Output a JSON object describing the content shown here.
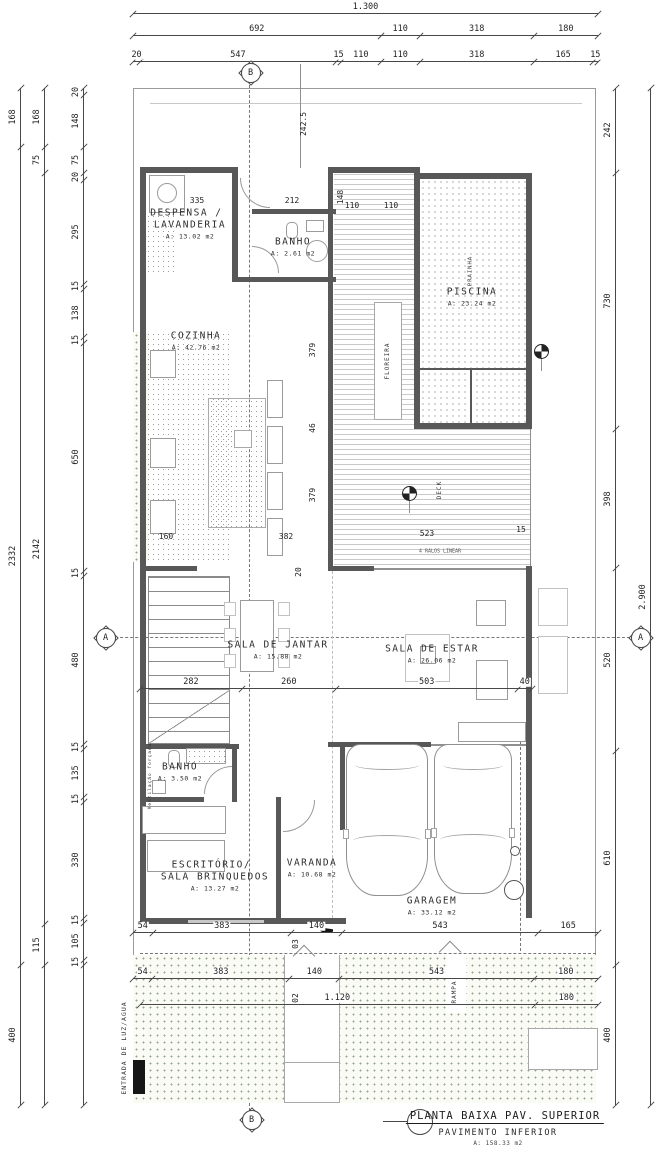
{
  "drawing": {
    "colors": {
      "wall": "#585858",
      "dim_line": "#474747",
      "yard_dot": "#93a393",
      "deck_stripe": "#c9c9c9"
    },
    "title_block": {
      "title": "PLANTA BAIXA PAV. SUPERIOR",
      "subtitle": "PAVIMENTO INFERIOR",
      "area": "A: 158.33 m2"
    },
    "rooms": [
      {
        "id": "despensa",
        "name": "DESPENSA /",
        "name2": "LAVANDERIA",
        "area": "A: 13.02 m2",
        "x": 190,
        "y": 224
      },
      {
        "id": "banho1",
        "name": "BANHO",
        "name2": "",
        "area": "A: 2.61 m2",
        "x": 293,
        "y": 247
      },
      {
        "id": "cozinha",
        "name": "COZINHA",
        "name2": "",
        "area": "A: 42.76 m2",
        "x": 196,
        "y": 341
      },
      {
        "id": "piscina",
        "name": "PISCINA",
        "name2": "",
        "area": "A: 23.24 m2",
        "x": 472,
        "y": 297
      },
      {
        "id": "jantar",
        "name": "SALA DE JANTAR",
        "name2": "",
        "area": "A: 15.88 m2",
        "x": 278,
        "y": 650
      },
      {
        "id": "estar",
        "name": "SALA DE ESTAR",
        "name2": "",
        "area": "A: 26.06 m2",
        "x": 432,
        "y": 654
      },
      {
        "id": "banho2",
        "name": "BANHO",
        "name2": "",
        "area": "A: 3.50 m2",
        "x": 180,
        "y": 772
      },
      {
        "id": "escritorio",
        "name": "ESCRITÓRIO/",
        "name2": "SALA BRINQUEDOS",
        "area": "A: 13.27 m2",
        "x": 215,
        "y": 876
      },
      {
        "id": "varanda",
        "name": "VARANDA",
        "name2": "",
        "area": "A: 10.68 m2",
        "x": 312,
        "y": 868
      },
      {
        "id": "garagem",
        "name": "GARAGEM",
        "name2": "",
        "area": "A: 33.12 m2",
        "x": 432,
        "y": 906
      }
    ],
    "vertical_labels": [
      {
        "text": "FLOREIRA",
        "x": 388,
        "y": 361,
        "size": 6
      },
      {
        "text": "PRAINHA",
        "x": 471,
        "y": 271,
        "size": 5.5
      },
      {
        "text": "DECK",
        "x": 440,
        "y": 490,
        "size": 6
      },
      {
        "text": "RAMPA",
        "x": 455,
        "y": 992,
        "size": 6
      },
      {
        "text": "ENTRADA DE LUZ/AGUA",
        "x": 124,
        "y": 1048,
        "size": 6.5
      },
      {
        "text": "Ventilação forçada",
        "x": 151,
        "y": 776,
        "size": 4.5
      }
    ],
    "markers": [
      {
        "letter": "B",
        "x": 250,
        "y": 72
      },
      {
        "letter": "B",
        "x": 251,
        "y": 1119
      },
      {
        "letter": "A",
        "x": 105,
        "y": 637
      },
      {
        "letter": "A",
        "x": 640,
        "y": 637
      }
    ],
    "dim_rows": [
      {
        "id": "top-total",
        "y": 13,
        "x1": 133,
        "x2": 598,
        "values": [
          "1.300"
        ],
        "weights": [
          1
        ]
      },
      {
        "id": "top-2",
        "y": 35,
        "x1": 133,
        "x2": 598,
        "values": [
          "692",
          "110",
          "318",
          "180"
        ],
        "weights": [
          692,
          110,
          318,
          180
        ]
      },
      {
        "id": "top-3",
        "y": 61,
        "x1": 133,
        "x2": 598,
        "values": [
          "20",
          "547",
          "15",
          "110",
          "110",
          "318",
          "165",
          "15"
        ],
        "weights": [
          20,
          547,
          15,
          110,
          110,
          318,
          165,
          15
        ]
      },
      {
        "id": "mid",
        "y": 688,
        "x1": 140,
        "x2": 532,
        "values": [
          "282",
          "260",
          "503",
          "40"
        ],
        "weights": [
          282,
          260,
          503,
          40
        ]
      },
      {
        "id": "bottom-1",
        "y": 932,
        "x1": 133,
        "x2": 598,
        "values": [
          "54",
          "383",
          "140",
          "543",
          "165"
        ],
        "weights": [
          54,
          383,
          140,
          543,
          165
        ]
      },
      {
        "id": "bottom-2",
        "y": 978,
        "x1": 133,
        "x2": 598,
        "values": [
          "54",
          "383",
          "140",
          "543",
          "180"
        ],
        "weights": [
          54,
          383,
          140,
          543,
          180
        ]
      },
      {
        "id": "bottom-3",
        "y": 1004,
        "x1": 140,
        "x2": 598,
        "values": [
          "1.120",
          "180"
        ],
        "weights": [
          1120,
          180
        ]
      }
    ],
    "dim_cols": [
      {
        "id": "left-outer",
        "x": 20,
        "y1": 88,
        "y2": 1105,
        "values": [
          "168",
          "2332",
          "400"
        ],
        "weights": [
          168,
          2332,
          400
        ]
      },
      {
        "id": "left-mid",
        "x": 44,
        "y1": 88,
        "y2": 1105,
        "values": [
          "168",
          "75",
          "2142",
          "115",
          ""
        ],
        "weights": [
          168,
          75,
          2142,
          115,
          400
        ]
      },
      {
        "id": "left-inner",
        "x": 83,
        "y1": 88,
        "y2": 1105,
        "values": [
          "20",
          "148",
          "75",
          "20",
          "295",
          "15",
          "138",
          "15",
          "650",
          "15",
          "480",
          "15",
          "135",
          "15",
          "330",
          "15",
          "105",
          "15",
          ""
        ],
        "weights": [
          20,
          148,
          75,
          20,
          295,
          15,
          138,
          15,
          650,
          15,
          480,
          15,
          135,
          15,
          330,
          15,
          105,
          15,
          399
        ]
      },
      {
        "id": "right-inner",
        "x": 615,
        "y1": 88,
        "y2": 1105,
        "values": [
          "242",
          "730",
          "398",
          "520",
          "610",
          "400"
        ],
        "weights": [
          242,
          730,
          398,
          520,
          610,
          400
        ]
      },
      {
        "id": "right-outer",
        "x": 650,
        "y1": 88,
        "y2": 1105,
        "values": [
          "2.900"
        ],
        "weights": [
          1
        ]
      }
    ],
    "inline_dims": [
      {
        "t": "335",
        "x": 197,
        "y": 201
      },
      {
        "t": "212",
        "x": 292,
        "y": 201
      },
      {
        "t": "110",
        "x": 352,
        "y": 206
      },
      {
        "t": "110",
        "x": 391,
        "y": 206
      },
      {
        "t": "148",
        "x": 341,
        "y": 197,
        "rot": 1
      },
      {
        "t": "242.5",
        "x": 304,
        "y": 124,
        "rot": 1
      },
      {
        "t": "379",
        "x": 313,
        "y": 350,
        "rot": 1
      },
      {
        "t": "46",
        "x": 313,
        "y": 428,
        "rot": 1
      },
      {
        "t": "379",
        "x": 313,
        "y": 495,
        "rot": 1
      },
      {
        "t": "160",
        "x": 166,
        "y": 537
      },
      {
        "t": "382",
        "x": 286,
        "y": 537
      },
      {
        "t": "523",
        "x": 427,
        "y": 534
      },
      {
        "t": "15",
        "x": 521,
        "y": 530
      },
      {
        "t": "20",
        "x": 299,
        "y": 572,
        "rot": 1
      },
      {
        "t": "03",
        "x": 296,
        "y": 944,
        "rot": 1
      },
      {
        "t": "02",
        "x": 296,
        "y": 998,
        "rot": 1
      }
    ],
    "notes": [
      {
        "t": "4 RALOS LINEAR",
        "x": 440,
        "y": 552,
        "size": 5
      }
    ]
  }
}
